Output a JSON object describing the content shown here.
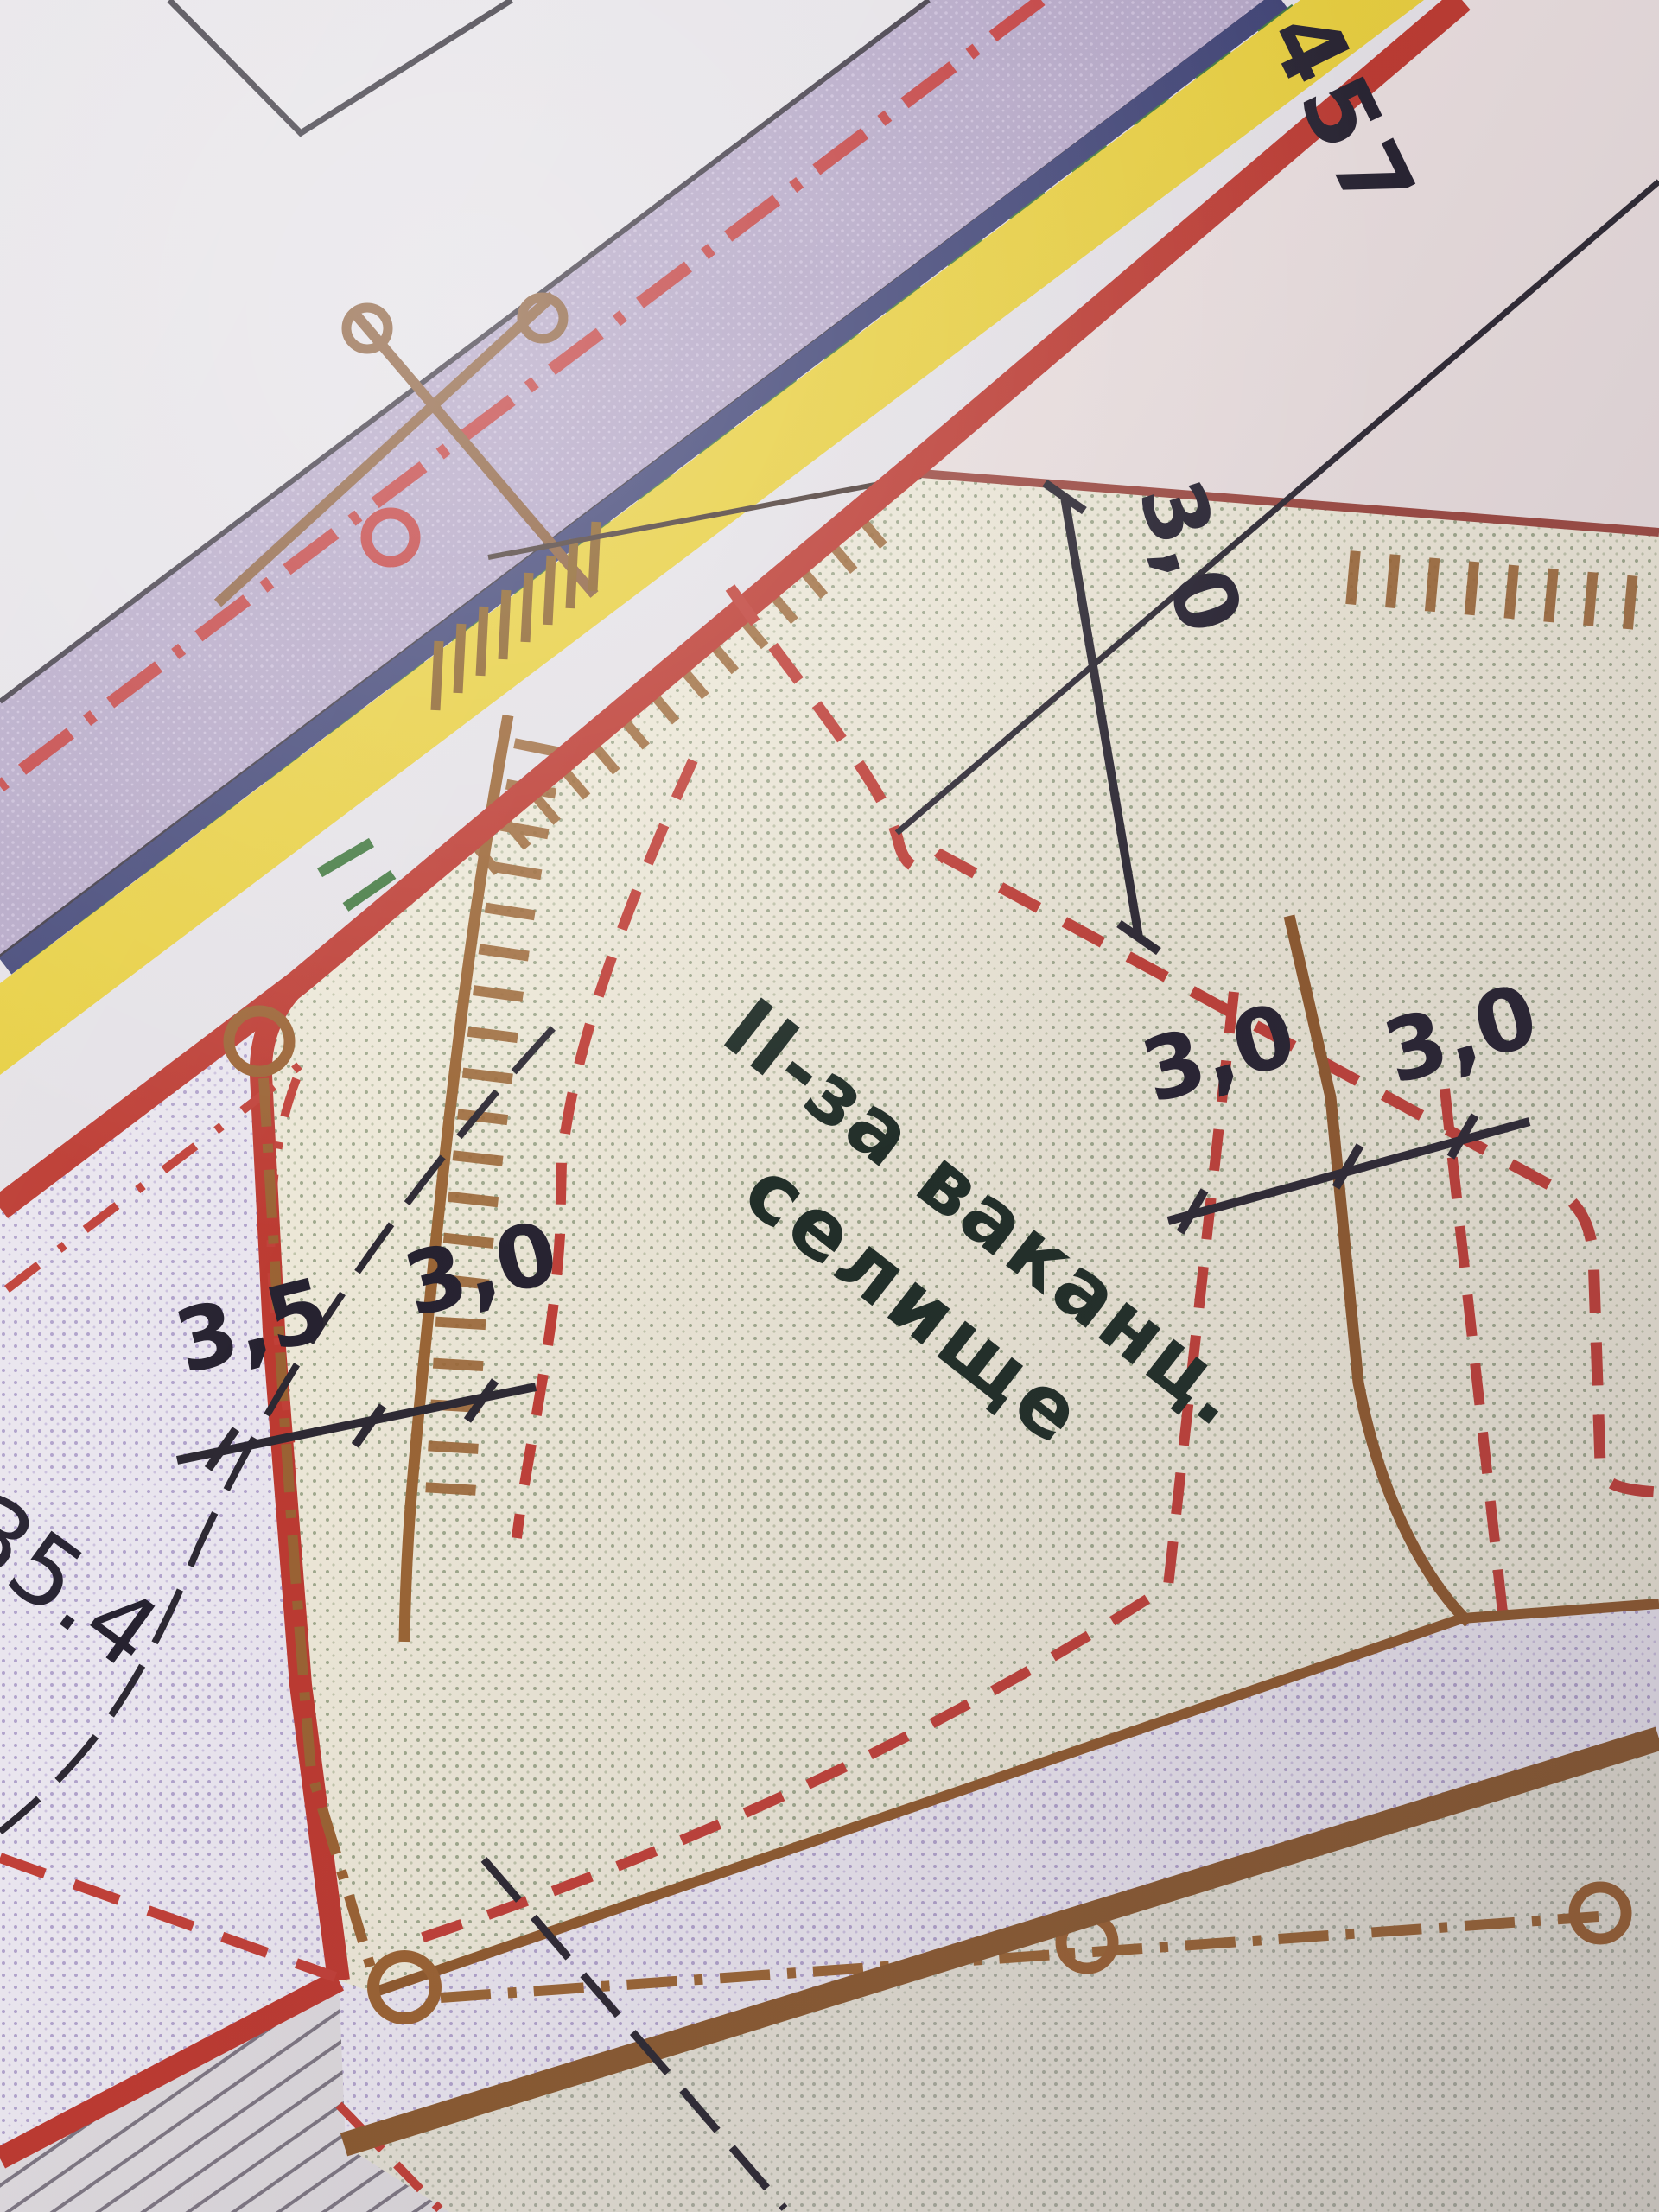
{
  "map": {
    "description": "Photographed fragment of a printed town-planning (zoning) map, Ukrainian",
    "zone_label": {
      "line1": "ІІ-за ваканц.",
      "line2": "селище"
    },
    "road_number": "457",
    "corner_mark": "35.4",
    "dimensions": {
      "top_setback": "3,0",
      "middle_left": "3,0",
      "middle_right": "3,0",
      "left_outer": "3,5",
      "left_inner": "3,0"
    },
    "colors": {
      "paper": "#e4e1e6",
      "pink_zone": "#e9dede",
      "purple_band": "#b3a5c5",
      "navy_line": "#3e4274",
      "green_dash": "#41783f",
      "yellow_band": "#e7ce3e",
      "red_boundary": "#bc3a31",
      "red_dashed": "#c04038",
      "brown_line": "#9a6535",
      "brown_thick": "#8a5a30",
      "black_ink": "#2d2933",
      "beige_parcel": "#ece7d7",
      "label_ink": "#1f2d26"
    }
  }
}
